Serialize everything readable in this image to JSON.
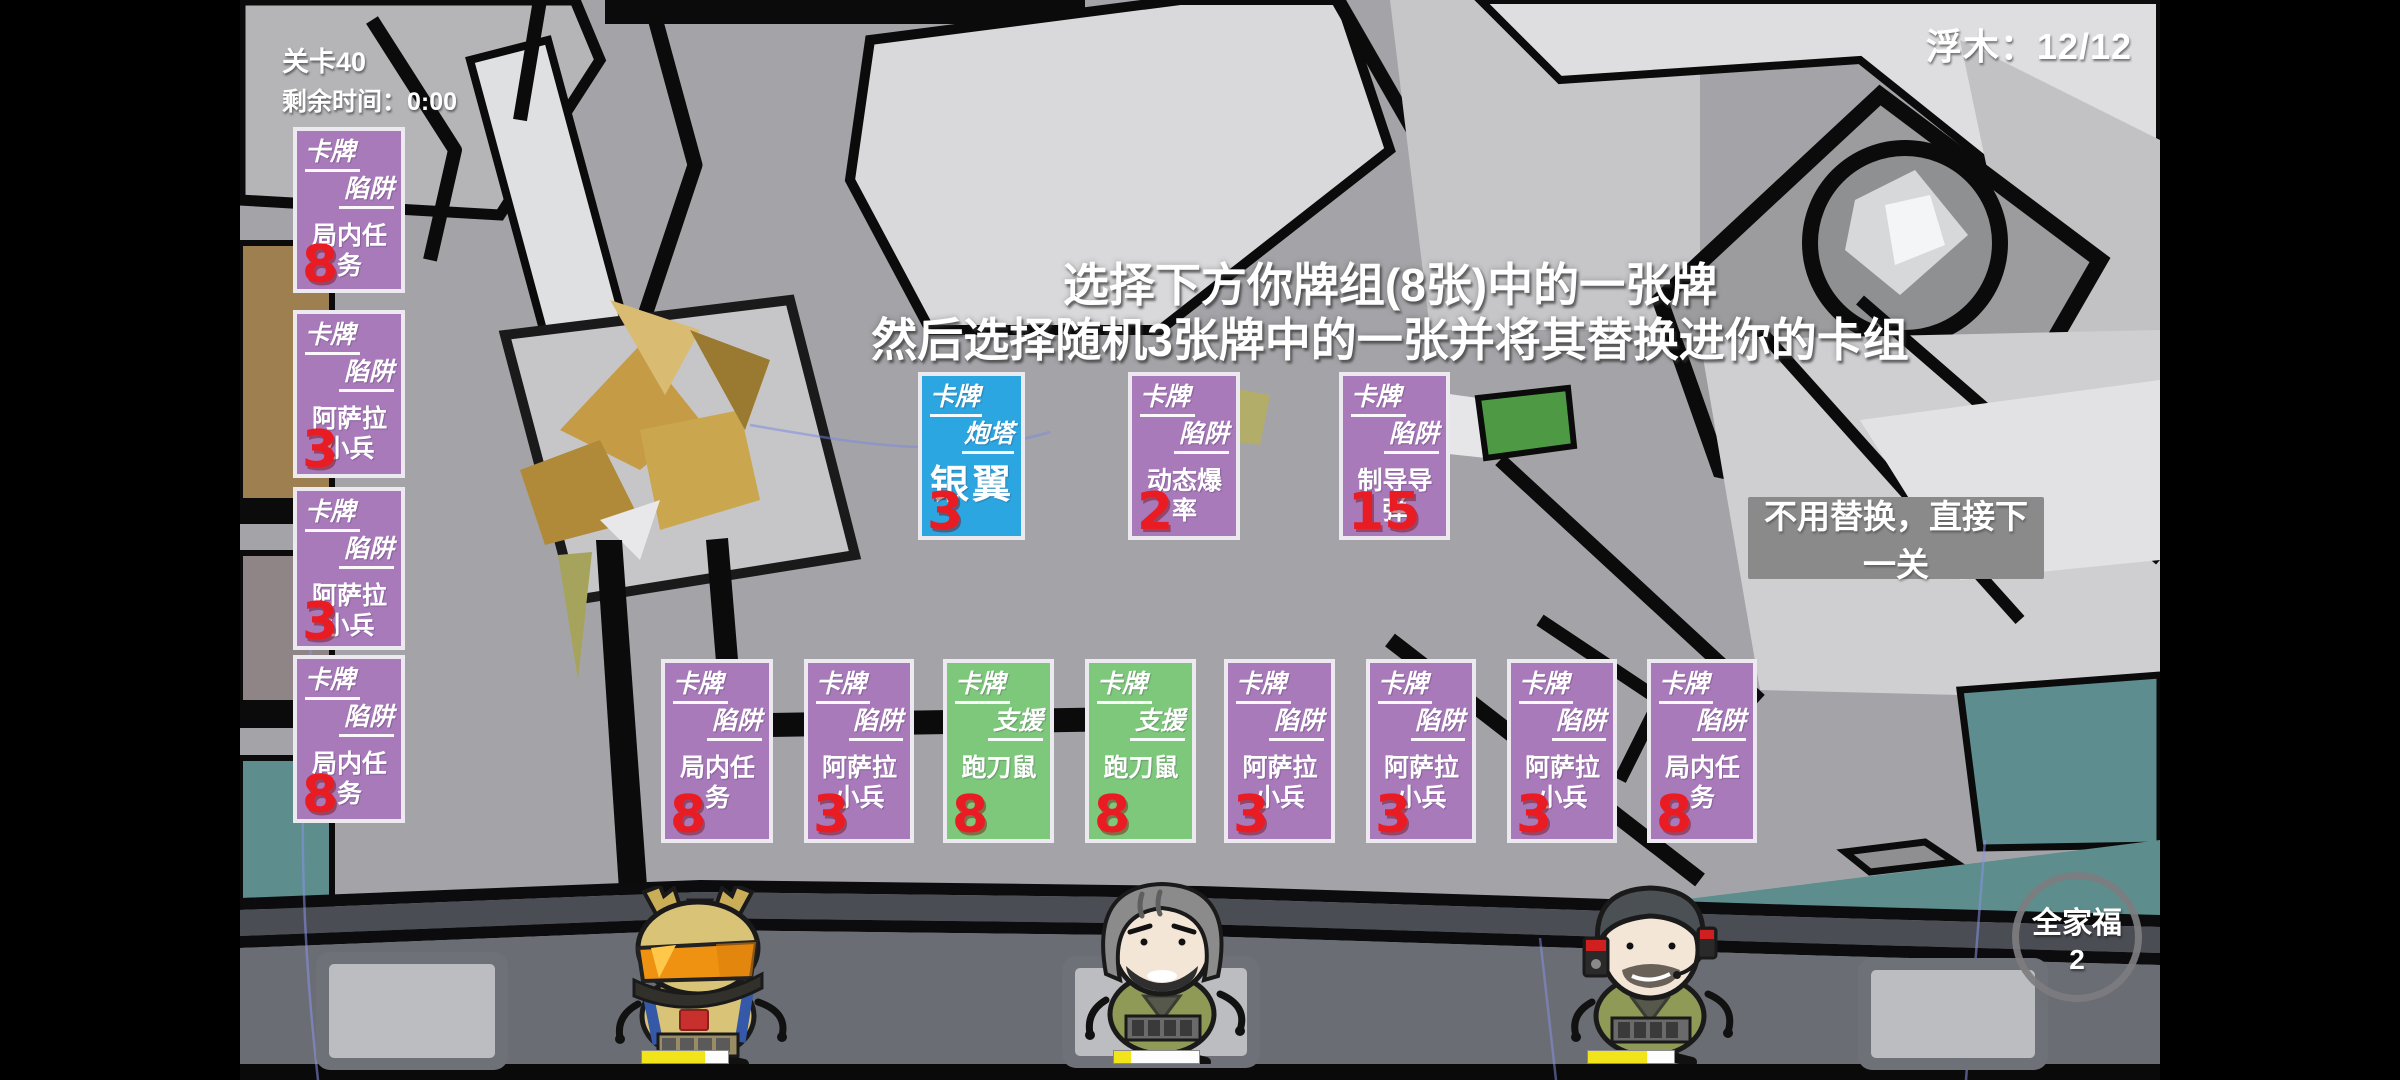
{
  "hud": {
    "level_label": "关卡40",
    "time_label": "剩余时间：0:00",
    "driftwood_label": "浮木：12/12",
    "instructions": {
      "line1": "选择下方你牌组(8张)中的一张牌",
      "line2": "然后选择随机3张牌中的一张并将其替换进你的卡组"
    },
    "skip_button_label": "不用替换，直接下一关",
    "group_photo": {
      "label": "全家福",
      "count": "2"
    }
  },
  "cards": {
    "left_column": [
      {
        "type1": "卡牌",
        "type2": "陷阱",
        "name": "局内任务",
        "cost": "8",
        "variant": "purple"
      },
      {
        "type1": "卡牌",
        "type2": "陷阱",
        "name": "阿萨拉",
        "name2": "小兵",
        "cost": "3",
        "variant": "purple"
      },
      {
        "type1": "卡牌",
        "type2": "陷阱",
        "name": "阿萨拉",
        "name2": "小兵",
        "cost": "3",
        "variant": "purple"
      },
      {
        "type1": "卡牌",
        "type2": "陷阱",
        "name": "局内任务",
        "cost": "8",
        "variant": "purple"
      }
    ],
    "choices": [
      {
        "type1": "卡牌",
        "type2": "炮塔",
        "name": "银翼",
        "cost": "3",
        "variant": "blue",
        "big_name": true
      },
      {
        "type1": "卡牌",
        "type2": "陷阱",
        "name": "动态爆率",
        "cost": "2",
        "variant": "purple"
      },
      {
        "type1": "卡牌",
        "type2": "陷阱",
        "name": "制导导弹",
        "cost": "15",
        "variant": "purple"
      }
    ],
    "deck": [
      {
        "type1": "卡牌",
        "type2": "陷阱",
        "name": "局内任务",
        "cost": "8",
        "variant": "purple"
      },
      {
        "type1": "卡牌",
        "type2": "陷阱",
        "name": "阿萨拉",
        "name2": "小兵",
        "cost": "3",
        "variant": "purple"
      },
      {
        "type1": "卡牌",
        "type2": "支援",
        "name": "跑刀鼠",
        "cost": "8",
        "variant": "green"
      },
      {
        "type1": "卡牌",
        "type2": "支援",
        "name": "跑刀鼠",
        "cost": "8",
        "variant": "green"
      },
      {
        "type1": "卡牌",
        "type2": "陷阱",
        "name": "阿萨拉",
        "name2": "小兵",
        "cost": "3",
        "variant": "purple"
      },
      {
        "type1": "卡牌",
        "type2": "陷阱",
        "name": "阿萨拉",
        "name2": "小兵",
        "cost": "3",
        "variant": "purple"
      },
      {
        "type1": "卡牌",
        "type2": "陷阱",
        "name": "阿萨拉",
        "name2": "小兵",
        "cost": "3",
        "variant": "purple"
      },
      {
        "type1": "卡牌",
        "type2": "陷阱",
        "name": "局内任务",
        "cost": "8",
        "variant": "purple"
      }
    ]
  },
  "characters": [
    {
      "name": "tan-helmet-soldier",
      "hp_percent": 73
    },
    {
      "name": "gray-hair-beard-soldier",
      "hp_percent": 20
    },
    {
      "name": "helmet-headset-soldier",
      "hp_percent": 69
    }
  ],
  "colors": {
    "card_purple": "#a87aba",
    "card_green": "#7ec87c",
    "card_blue": "#2ca6e0",
    "cost_red": "#ea1c23",
    "hp_yellow": "#f2e41a",
    "street_gray": "#6a6d74",
    "map_gray": "#a4a4a8"
  }
}
